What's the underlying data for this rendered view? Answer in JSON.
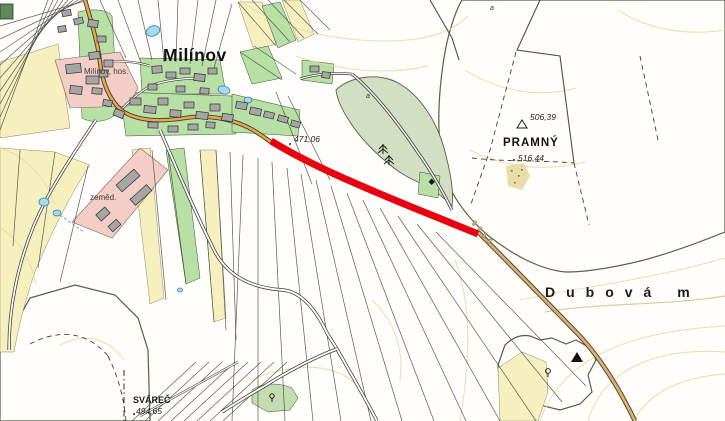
{
  "map": {
    "place_labels": {
      "village": "Milínov",
      "farm_note": "Milínov, hos.",
      "farm_abbr": "zeměd.",
      "hill": "PRAMNÝ",
      "region": "Dubová m",
      "settlement_sw": "SVÁREČ",
      "scrub_abbr": "a"
    },
    "elevation_labels": {
      "road_spot": "471,06",
      "trig_point": "506,39",
      "forest_spot": "516,44",
      "sw_spot": "494,65"
    },
    "colors": {
      "route_red": "#e80010",
      "forest_green": "#d2dfc3",
      "garden_green": "#b7e0a4",
      "field_yellow": "#f6efbe",
      "farm_pink": "#f3cec6",
      "water_blue": "#a8d9ec",
      "road_orange": "#e8a844",
      "road_tan": "#ddb268",
      "building_gray": "#a6a6a6",
      "contour_tan": "#e8d9ab"
    }
  }
}
